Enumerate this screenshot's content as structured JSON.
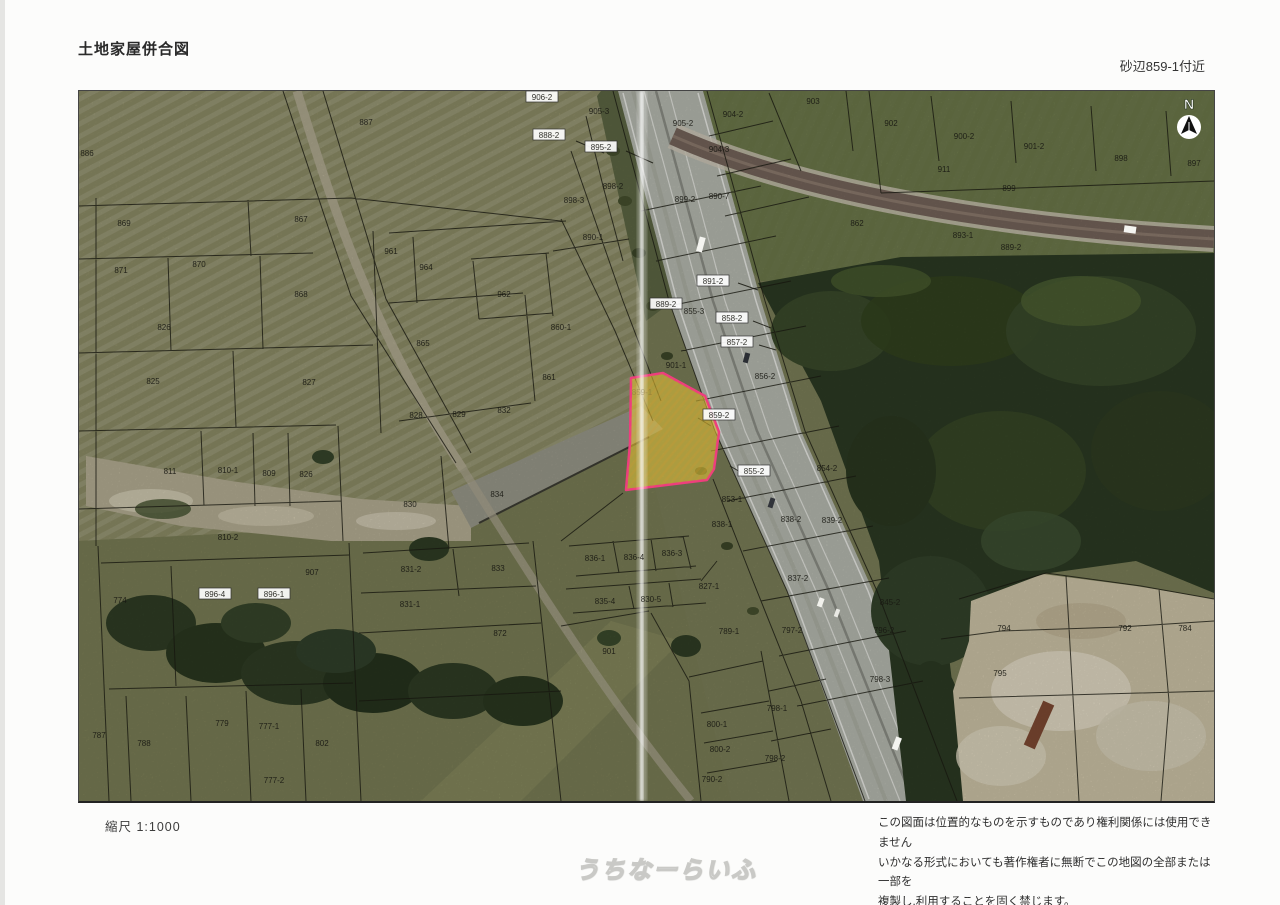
{
  "page": {
    "title": "土地家屋併合図",
    "location_label": "砂辺859-1付近",
    "scale_label": "縮尺 1:1000",
    "north_label": "N",
    "watermark": "うちなーらいふ",
    "disclaimer_lines": [
      "この図面は位置的なものを示すものであり権利関係には使用できません",
      "いかなる形式においても著作権者に無断でこの地図の全部または一部を",
      "複製し,利用することを固く禁じます。"
    ]
  },
  "colors": {
    "highlight_fill": "#f3cf35",
    "highlight_border": "#ee3d7e",
    "boundary_line": "#17170f",
    "label_text": "#181812"
  },
  "map": {
    "highlight_parcel_label": "859-1",
    "parcels": [
      {
        "t": "906-2",
        "x": 541,
        "y": 96,
        "box": true
      },
      {
        "t": "905-3",
        "x": 598,
        "y": 110
      },
      {
        "t": "905-2",
        "x": 682,
        "y": 122
      },
      {
        "t": "904-2",
        "x": 732,
        "y": 113
      },
      {
        "t": "903",
        "x": 812,
        "y": 100
      },
      {
        "t": "902",
        "x": 890,
        "y": 122
      },
      {
        "t": "900-2",
        "x": 963,
        "y": 135
      },
      {
        "t": "901-2",
        "x": 1033,
        "y": 145
      },
      {
        "t": "898",
        "x": 1120,
        "y": 157
      },
      {
        "t": "897",
        "x": 1193,
        "y": 162
      },
      {
        "t": "899",
        "x": 1008,
        "y": 187
      },
      {
        "t": "911",
        "x": 943,
        "y": 168
      },
      {
        "t": "862",
        "x": 856,
        "y": 222
      },
      {
        "t": "893-1",
        "x": 962,
        "y": 234
      },
      {
        "t": "889-2",
        "x": 1010,
        "y": 246
      },
      {
        "t": "888-2",
        "x": 548,
        "y": 134,
        "box": true
      },
      {
        "t": "895-2",
        "x": 600,
        "y": 146,
        "box": true
      },
      {
        "t": "904-3",
        "x": 718,
        "y": 148
      },
      {
        "t": "898-2",
        "x": 612,
        "y": 185
      },
      {
        "t": "898-3",
        "x": 573,
        "y": 199
      },
      {
        "t": "899-2",
        "x": 684,
        "y": 198
      },
      {
        "t": "890-7",
        "x": 718,
        "y": 195
      },
      {
        "t": "890-1",
        "x": 592,
        "y": 236
      },
      {
        "t": "886",
        "x": 86,
        "y": 152
      },
      {
        "t": "887",
        "x": 365,
        "y": 121
      },
      {
        "t": "869",
        "x": 123,
        "y": 222
      },
      {
        "t": "867",
        "x": 300,
        "y": 218
      },
      {
        "t": "871",
        "x": 120,
        "y": 269
      },
      {
        "t": "870",
        "x": 198,
        "y": 263
      },
      {
        "t": "868",
        "x": 300,
        "y": 293
      },
      {
        "t": "961",
        "x": 390,
        "y": 250
      },
      {
        "t": "964",
        "x": 425,
        "y": 266
      },
      {
        "t": "962",
        "x": 503,
        "y": 293
      },
      {
        "t": "826",
        "x": 163,
        "y": 326
      },
      {
        "t": "825",
        "x": 152,
        "y": 380
      },
      {
        "t": "827",
        "x": 308,
        "y": 381
      },
      {
        "t": "865",
        "x": 422,
        "y": 342
      },
      {
        "t": "860-1",
        "x": 560,
        "y": 326
      },
      {
        "t": "861",
        "x": 548,
        "y": 376
      },
      {
        "t": "828",
        "x": 415,
        "y": 414
      },
      {
        "t": "829",
        "x": 458,
        "y": 413
      },
      {
        "t": "832",
        "x": 503,
        "y": 409
      },
      {
        "t": "811",
        "x": 169,
        "y": 470
      },
      {
        "t": "810-1",
        "x": 227,
        "y": 469
      },
      {
        "t": "809",
        "x": 268,
        "y": 472
      },
      {
        "t": "826",
        "x": 305,
        "y": 473
      },
      {
        "t": "810-2",
        "x": 227,
        "y": 536
      },
      {
        "t": "891-2",
        "x": 712,
        "y": 280,
        "box": true
      },
      {
        "t": "889-2",
        "x": 665,
        "y": 303,
        "box": true
      },
      {
        "t": "855-3",
        "x": 693,
        "y": 310
      },
      {
        "t": "858-2",
        "x": 731,
        "y": 317,
        "box": true
      },
      {
        "t": "857-2",
        "x": 736,
        "y": 341,
        "box": true
      },
      {
        "t": "856-2",
        "x": 764,
        "y": 375
      },
      {
        "t": "901-1",
        "x": 675,
        "y": 364
      },
      {
        "t": "859-1",
        "x": 641,
        "y": 391,
        "faint": true
      },
      {
        "t": "859-2",
        "x": 718,
        "y": 414,
        "box": true
      },
      {
        "t": "855-2",
        "x": 753,
        "y": 470,
        "box": true
      },
      {
        "t": "854-2",
        "x": 826,
        "y": 467
      },
      {
        "t": "853-1",
        "x": 731,
        "y": 498
      },
      {
        "t": "838-1",
        "x": 721,
        "y": 523
      },
      {
        "t": "838-2",
        "x": 790,
        "y": 518
      },
      {
        "t": "839-2",
        "x": 831,
        "y": 519
      },
      {
        "t": "837-2",
        "x": 797,
        "y": 577
      },
      {
        "t": "845-2",
        "x": 889,
        "y": 601
      },
      {
        "t": "827-1",
        "x": 708,
        "y": 585
      },
      {
        "t": "836-1",
        "x": 594,
        "y": 557
      },
      {
        "t": "836-4",
        "x": 633,
        "y": 556
      },
      {
        "t": "836-3",
        "x": 671,
        "y": 552
      },
      {
        "t": "835-4",
        "x": 604,
        "y": 600
      },
      {
        "t": "830-5",
        "x": 650,
        "y": 598
      },
      {
        "t": "830",
        "x": 409,
        "y": 503
      },
      {
        "t": "834",
        "x": 496,
        "y": 493
      },
      {
        "t": "833",
        "x": 497,
        "y": 567
      },
      {
        "t": "831-2",
        "x": 410,
        "y": 568
      },
      {
        "t": "831-1",
        "x": 409,
        "y": 603
      },
      {
        "t": "872",
        "x": 499,
        "y": 632
      },
      {
        "t": "907",
        "x": 311,
        "y": 571
      },
      {
        "t": "901",
        "x": 608,
        "y": 650
      },
      {
        "t": "800-1",
        "x": 716,
        "y": 723
      },
      {
        "t": "800-2",
        "x": 719,
        "y": 748
      },
      {
        "t": "790-2",
        "x": 711,
        "y": 778
      },
      {
        "t": "798-1",
        "x": 776,
        "y": 707
      },
      {
        "t": "798-2",
        "x": 774,
        "y": 757
      },
      {
        "t": "798-3",
        "x": 879,
        "y": 678
      },
      {
        "t": "797-2",
        "x": 791,
        "y": 629
      },
      {
        "t": "789-1",
        "x": 728,
        "y": 630
      },
      {
        "t": "796-2",
        "x": 883,
        "y": 629
      },
      {
        "t": "794",
        "x": 1003,
        "y": 627
      },
      {
        "t": "792",
        "x": 1124,
        "y": 627
      },
      {
        "t": "784",
        "x": 1184,
        "y": 627
      },
      {
        "t": "795",
        "x": 999,
        "y": 672
      },
      {
        "t": "774",
        "x": 119,
        "y": 599
      },
      {
        "t": "896-4",
        "x": 214,
        "y": 593,
        "box": true
      },
      {
        "t": "896-1",
        "x": 273,
        "y": 593,
        "box": true
      },
      {
        "t": "787",
        "x": 98,
        "y": 734
      },
      {
        "t": "788",
        "x": 143,
        "y": 742
      },
      {
        "t": "779",
        "x": 221,
        "y": 722
      },
      {
        "t": "777-1",
        "x": 268,
        "y": 725
      },
      {
        "t": "777-2",
        "x": 273,
        "y": 779
      },
      {
        "t": "802",
        "x": 321,
        "y": 742
      }
    ]
  }
}
